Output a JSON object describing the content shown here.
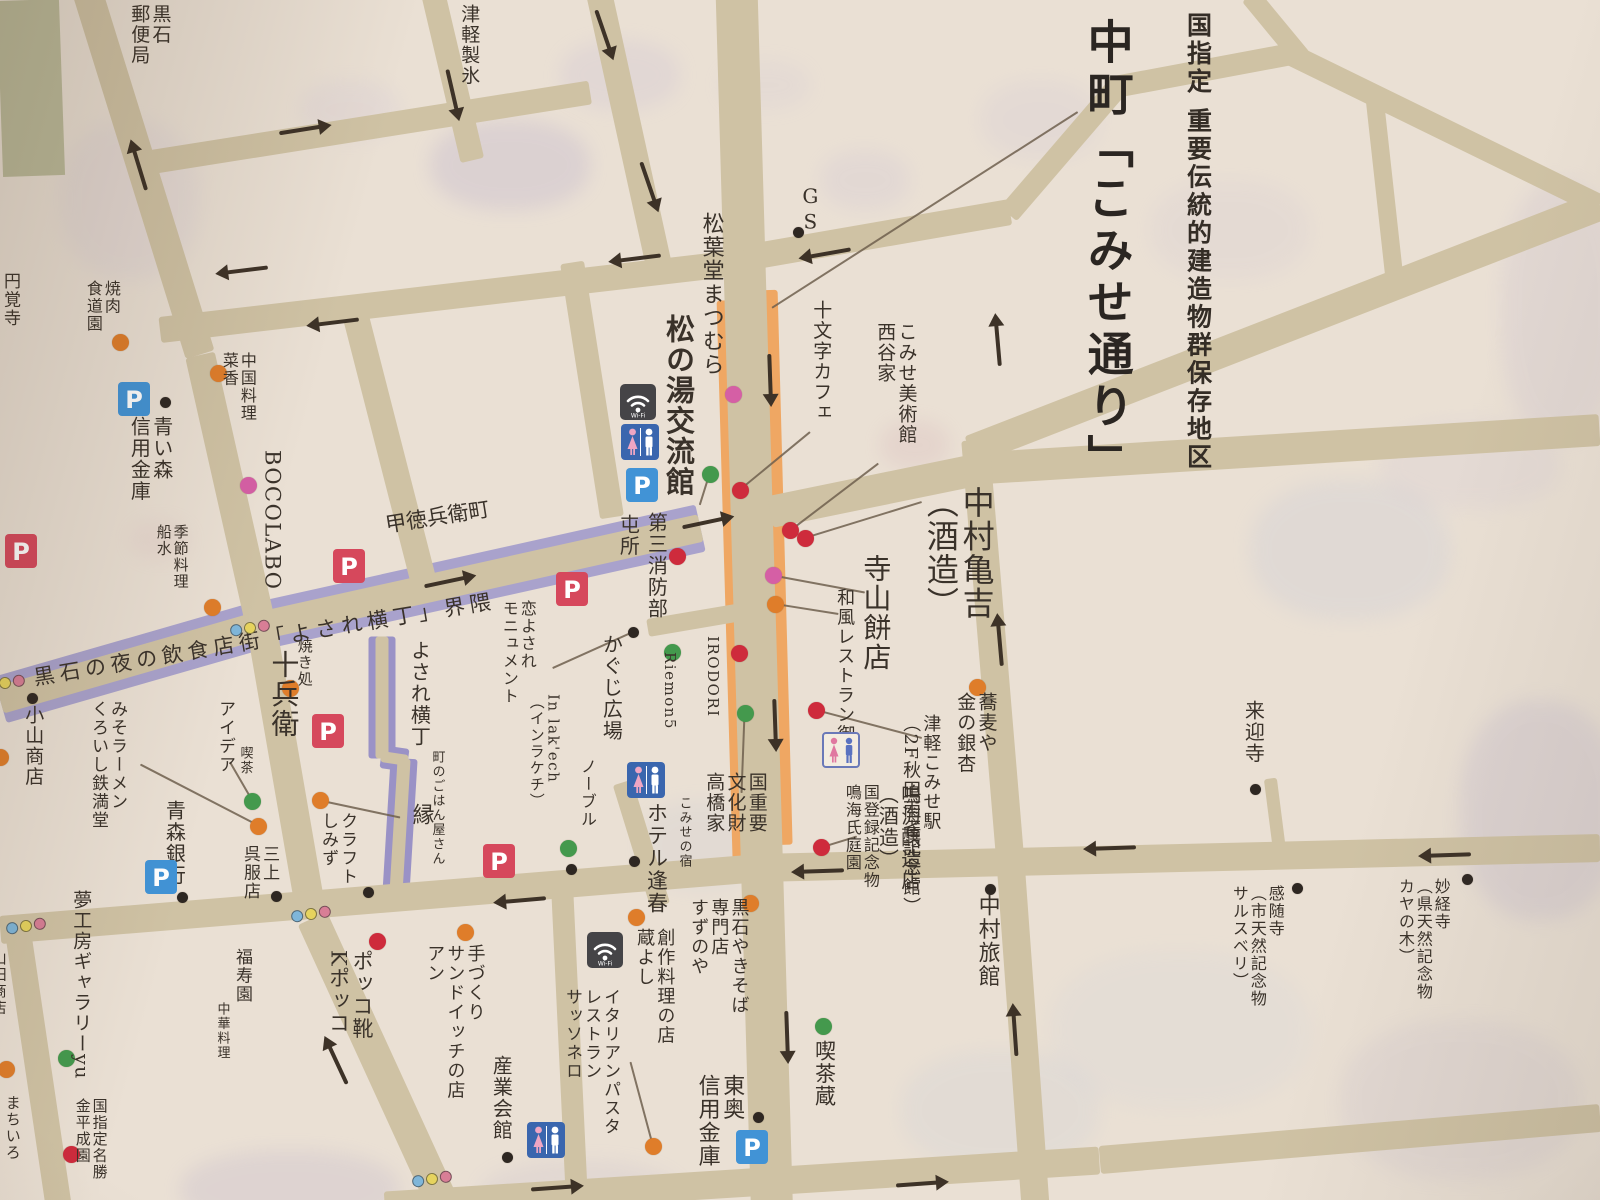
{
  "title": {
    "main": "中町「こみせ通り」",
    "sub": "国指定 重要伝統的建造物群保存地区"
  },
  "colors": {
    "paper": "#eae0d4",
    "road": "#cfc2a4",
    "purple": "#a9a2cc",
    "purple_lane": "#9a92c6",
    "arcade": "#efa763",
    "plaza": "#b7b795",
    "ink": "#3a322a",
    "arrow": "#3d3227",
    "leader_line": "#6e5f4e",
    "dot": {
      "o": "#df7d2a",
      "r": "#ce2b3c",
      "g": "#44994d",
      "p": "#d55fa5",
      "k": "#2e2722"
    },
    "traffic_light": [
      "#7fb6d9",
      "#e6d35e",
      "#d87e96"
    ],
    "parking_blue": "#4193d6",
    "parking_red": "#d6485c"
  },
  "plaza": {
    "x": 588,
    "y": 616,
    "w": 62,
    "h": 176
  },
  "roads": [
    [
      736,
      -20,
      772,
      1220,
      42
    ],
    [
      85,
      -15,
      200,
      355,
      30
    ],
    [
      200,
      355,
      263,
      635,
      30
    ],
    [
      263,
      635,
      312,
      918,
      30
    ],
    [
      312,
      918,
      448,
      1215,
      32
    ],
    [
      598,
      -10,
      660,
      272,
      26
    ],
    [
      572,
      262,
      612,
      517,
      24
    ],
    [
      130,
      165,
      590,
      92,
      24
    ],
    [
      432,
      -10,
      472,
      160,
      24
    ],
    [
      160,
      330,
      745,
      262,
      26
    ],
    [
      745,
      258,
      1010,
      212,
      26
    ],
    [
      1008,
      214,
      1118,
      86,
      22
    ],
    [
      1110,
      88,
      1292,
      54,
      22
    ],
    [
      970,
      450,
      1600,
      205,
      30
    ],
    [
      1287,
      52,
      1600,
      205,
      22
    ],
    [
      1250,
      -5,
      1302,
      58,
      20
    ],
    [
      1375,
      98,
      1397,
      298,
      18
    ],
    [
      0,
      700,
      250,
      628,
      28
    ],
    [
      250,
      628,
      700,
      528,
      28
    ],
    [
      770,
      512,
      985,
      468,
      32
    ],
    [
      985,
      468,
      1600,
      430,
      32
    ],
    [
      975,
      440,
      1010,
      860,
      28
    ],
    [
      1010,
      860,
      1035,
      1205,
      28
    ],
    [
      0,
      930,
      760,
      868,
      28
    ],
    [
      760,
      868,
      1600,
      848,
      28
    ],
    [
      385,
      1205,
      1100,
      1160,
      28
    ],
    [
      1100,
      1160,
      1600,
      1118,
      28
    ],
    [
      18,
      935,
      58,
      1205,
      26
    ],
    [
      352,
      300,
      427,
      593,
      26
    ],
    [
      648,
      628,
      742,
      612,
      18
    ],
    [
      622,
      782,
      660,
      905,
      20
    ],
    [
      382,
      636,
      382,
      758,
      13
    ],
    [
      381,
      756,
      408,
      760,
      11
    ],
    [
      404,
      758,
      396,
      890,
      13
    ],
    [
      1270,
      778,
      1280,
      856,
      13
    ],
    [
      562,
      888,
      577,
      1205,
      22
    ]
  ],
  "bands": {
    "purple": [
      [
        0,
        700,
        250,
        628,
        48
      ],
      [
        250,
        628,
        700,
        528,
        48
      ]
    ],
    "purple_lane": [
      [
        382,
        636,
        382,
        758,
        27
      ],
      [
        381,
        756,
        408,
        760,
        23
      ],
      [
        404,
        758,
        396,
        890,
        27
      ]
    ],
    "arcade": [
      [
        723,
        300,
        739,
        860,
        13
      ],
      [
        770,
        290,
        785,
        845,
        15
      ]
    ]
  },
  "labels": [
    {
      "n": "kuroishi-post-office",
      "t": "黒石\n郵便局",
      "x": 128,
      "y": 4,
      "s": 19,
      "v": 1
    },
    {
      "n": "tsugaru-seihyo",
      "t": "津軽製氷",
      "x": 458,
      "y": 4,
      "s": 19,
      "v": 1
    },
    {
      "n": "enkakuji-temple",
      "t": "円覚寺",
      "x": 0,
      "y": 272,
      "s": 17,
      "v": 1
    },
    {
      "n": "yakiniku-shokudoen",
      "t": "焼肉\n食道園",
      "x": 84,
      "y": 280,
      "s": 16,
      "v": 1
    },
    {
      "n": "aoimori-shinkin-bank",
      "t": "青い森\n信用金庫",
      "x": 128,
      "y": 416,
      "s": 20,
      "v": 1
    },
    {
      "n": "chinese-restaurant-saika",
      "t": "中国料理\n菜香",
      "x": 220,
      "y": 352,
      "s": 16,
      "v": 1
    },
    {
      "n": "bocolabo",
      "t": "BOCOLABO",
      "x": 260,
      "y": 450,
      "s": 21,
      "v": 1,
      "o": "s"
    },
    {
      "n": "kisetsu-ryori-funamizu",
      "t": "季節料理\n船水",
      "x": 155,
      "y": 524,
      "s": 15,
      "v": 1
    },
    {
      "n": "kotokubee-cho",
      "t": "甲徳兵衛町",
      "x": 385,
      "y": 506,
      "s": 21,
      "r": -9
    },
    {
      "n": "yosare-yokocho-street",
      "t": "黒石の夜の飲食店街「よされ横丁」界隈",
      "x": 30,
      "y": 620,
      "s": 21,
      "r": -9.5,
      "w": 570,
      "ls": 5
    },
    {
      "n": "tonsho",
      "t": "屯所",
      "x": 617,
      "y": 514,
      "s": 20,
      "v": 1
    },
    {
      "n": "daisan-shobobu",
      "t": "第三消防部",
      "x": 645,
      "y": 512,
      "s": 20,
      "v": 1
    },
    {
      "n": "matsubado-matsumura",
      "t": "松葉堂まつむら",
      "x": 698,
      "y": 212,
      "s": 22,
      "v": 1
    },
    {
      "n": "matsunoyu-koryukan",
      "t": "松の湯交流館",
      "x": 662,
      "y": 314,
      "s": 29,
      "v": 1,
      "b": 1
    },
    {
      "n": "gs-gas-station",
      "t": "GS",
      "x": 799,
      "y": 184,
      "s": 20,
      "v": 1,
      "o": "u"
    },
    {
      "n": "jumonji-cafe",
      "t": "十文字カフェ",
      "x": 810,
      "y": 300,
      "s": 19,
      "v": 1
    },
    {
      "n": "komise-museum-nishitaniya",
      "t": "こみせ美術館\n西谷家",
      "x": 874,
      "y": 322,
      "s": 19,
      "v": 1
    },
    {
      "n": "nakamura-kamekichi-brewery",
      "t": "中村亀吉\n（酒造）",
      "x": 922,
      "y": 486,
      "s": 32,
      "v": 1
    },
    {
      "n": "terayama-mochiten",
      "t": "寺山餅店",
      "x": 860,
      "y": 554,
      "s": 28,
      "v": 1
    },
    {
      "n": "wafu-restaurant-miyuki",
      "t": "和風レストラン御幸",
      "x": 834,
      "y": 588,
      "s": 18,
      "v": 1
    },
    {
      "n": "tsugaru-komise-station",
      "t": "津軽こみせ駅\n（2F秋田雨雀記念館）",
      "x": 900,
      "y": 714,
      "s": 18,
      "v": 1
    },
    {
      "n": "sobaya-kin-no-icho",
      "t": "蕎麦や\n金の銀杏",
      "x": 954,
      "y": 692,
      "s": 19,
      "v": 1
    },
    {
      "n": "narumi-garden",
      "t": "国登録記念物\n鳴海氏庭園",
      "x": 843,
      "y": 784,
      "s": 16,
      "v": 1
    },
    {
      "n": "narumi-jozoten-brewery",
      "t": "鳴海醸造店\n（酒造）",
      "x": 876,
      "y": 784,
      "s": 20,
      "v": 1
    },
    {
      "n": "nakamura-ryokan",
      "t": "中村旅館",
      "x": 974,
      "y": 894,
      "s": 22,
      "v": 1
    },
    {
      "n": "kissa-kura",
      "t": "喫茶蔵",
      "x": 812,
      "y": 1040,
      "s": 21,
      "v": 1
    },
    {
      "n": "toou-shinkin-bank",
      "t": "東奥\n信用金庫",
      "x": 694,
      "y": 1074,
      "s": 22,
      "v": 1
    },
    {
      "n": "kuroishi-yakisoba-suzunoya",
      "t": "黒石やきそば\n専門店\nすずのや",
      "x": 688,
      "y": 898,
      "s": 18,
      "v": 1
    },
    {
      "n": "kurayoshi",
      "t": "創作料理の店\n蔵よし",
      "x": 634,
      "y": 928,
      "s": 18,
      "v": 1
    },
    {
      "n": "sassonero",
      "t": "イタリアンパスタ\nレストラン\nサッソネロ",
      "x": 562,
      "y": 988,
      "s": 17,
      "v": 1
    },
    {
      "n": "komise-no-yado",
      "t": "こみせの宿",
      "x": 676,
      "y": 796,
      "s": 13,
      "v": 1
    },
    {
      "n": "hotel-hoshun",
      "t": "ホテル逢春",
      "x": 644,
      "y": 802,
      "s": 21,
      "v": 1
    },
    {
      "n": "noble",
      "t": "ノーブル",
      "x": 578,
      "y": 758,
      "s": 16,
      "v": 1
    },
    {
      "n": "in-lakech",
      "t": "In lak'ech\n（インラケチ）",
      "x": 528,
      "y": 694,
      "s": 15,
      "v": 1
    },
    {
      "n": "koiyosare-monument",
      "t": "恋よされ\nモニュメント",
      "x": 500,
      "y": 600,
      "s": 16,
      "v": 1
    },
    {
      "n": "kaguji-hiroba",
      "t": "かぐじ広場",
      "x": 600,
      "y": 634,
      "s": 20,
      "v": 1
    },
    {
      "n": "riemon5",
      "t": "Riemon5",
      "x": 661,
      "y": 652,
      "s": 15,
      "v": 1,
      "o": "s"
    },
    {
      "n": "irodori",
      "t": "IRODORI",
      "x": 704,
      "y": 636,
      "s": 15,
      "v": 1,
      "o": "s"
    },
    {
      "n": "takahashi-house",
      "t": "国重要\n文化財\n高橋家",
      "x": 703,
      "y": 772,
      "s": 19,
      "v": 1
    },
    {
      "n": "yosare-yokocho",
      "t": "よされ横丁",
      "x": 408,
      "y": 640,
      "s": 20,
      "v": 1
    },
    {
      "n": "yakidokoro",
      "t": "焼き処",
      "x": 296,
      "y": 638,
      "s": 15,
      "v": 1
    },
    {
      "n": "jube",
      "t": "十兵衛",
      "x": 268,
      "y": 650,
      "s": 28,
      "v": 1
    },
    {
      "n": "idea",
      "t": "アイデア",
      "x": 215,
      "y": 700,
      "s": 17,
      "v": 1
    },
    {
      "n": "kissa",
      "t": "喫茶",
      "x": 237,
      "y": 746,
      "s": 13,
      "v": 1
    },
    {
      "n": "aomori-bank",
      "t": "青森銀行",
      "x": 163,
      "y": 800,
      "s": 20,
      "v": 1
    },
    {
      "n": "mikami-gofukuten",
      "t": "三上\n呉服店",
      "x": 240,
      "y": 845,
      "s": 17,
      "v": 1
    },
    {
      "n": "craft-shimizu",
      "t": "クラフト\nしみず",
      "x": 318,
      "y": 812,
      "s": 17,
      "v": 1
    },
    {
      "n": "machi-no-gohanyasan",
      "t": "町のごはん屋さん",
      "x": 429,
      "y": 750,
      "s": 13,
      "v": 1
    },
    {
      "n": "en",
      "t": "縁",
      "x": 408,
      "y": 803,
      "s": 22,
      "v": 1
    },
    {
      "n": "miso-ramen-tetsumando",
      "t": "みそラーメン\nくろいし鉄満堂",
      "x": 88,
      "y": 700,
      "s": 17,
      "v": 1
    },
    {
      "n": "koyama-shoten",
      "t": "小山商店",
      "x": 22,
      "y": 705,
      "s": 19,
      "v": 1
    },
    {
      "n": "yumekobo-gallery-yu",
      "t": "夢工房ギャラリーyu",
      "x": 70,
      "y": 890,
      "s": 19,
      "v": 1
    },
    {
      "n": "kanehira-narien",
      "t": "国指定名勝\n金平成園",
      "x": 74,
      "y": 1098,
      "s": 15,
      "v": 1
    },
    {
      "n": "machiiro",
      "t": "まちいろ",
      "x": 4,
      "y": 1095,
      "s": 15,
      "v": 1
    },
    {
      "n": "yamada-shoten",
      "t": "山田商店",
      "x": -10,
      "y": 950,
      "s": 15,
      "v": 1
    },
    {
      "n": "fukujuen",
      "t": "福寿園",
      "x": 232,
      "y": 948,
      "s": 17,
      "v": 1
    },
    {
      "n": "chuka-ryori",
      "t": "中華料理",
      "x": 214,
      "y": 1002,
      "s": 13,
      "v": 1
    },
    {
      "n": "tezukuri-sandwich-an",
      "t": "手づくり\nサンドイッチの店\nアン",
      "x": 424,
      "y": 944,
      "s": 18,
      "v": 1
    },
    {
      "n": "pokko-shoes",
      "t": "ポッコ靴\nKポッコ",
      "x": 326,
      "y": 950,
      "s": 21,
      "v": 1
    },
    {
      "n": "sangyo-kaikan",
      "t": "産業会館",
      "x": 490,
      "y": 1055,
      "s": 20,
      "v": 1
    },
    {
      "n": "raigoji-temple",
      "t": "来迎寺",
      "x": 1242,
      "y": 700,
      "s": 20,
      "v": 1
    },
    {
      "n": "kanzuiji-temple",
      "t": "感随寺\n（市天然記念物\nサルスベリ）",
      "x": 1230,
      "y": 885,
      "s": 16,
      "v": 1
    },
    {
      "n": "myokyoji-temple",
      "t": "妙経寺\n（県天然記念物\nカヤの木）",
      "x": 1396,
      "y": 878,
      "s": 16,
      "v": 1
    }
  ],
  "dots": [
    [
      120,
      342,
      "o"
    ],
    [
      218,
      373,
      "o"
    ],
    [
      248,
      485,
      "p"
    ],
    [
      165,
      402,
      "k"
    ],
    [
      212,
      607,
      "o"
    ],
    [
      290,
      688,
      "o"
    ],
    [
      252,
      801,
      "g"
    ],
    [
      258,
      826,
      "o"
    ],
    [
      320,
      800,
      "o"
    ],
    [
      182,
      897,
      "k"
    ],
    [
      276,
      896,
      "k"
    ],
    [
      368,
      892,
      "k"
    ],
    [
      32,
      698,
      "k"
    ],
    [
      733,
      394,
      "p"
    ],
    [
      710,
      474,
      "g"
    ],
    [
      740,
      490,
      "r"
    ],
    [
      677,
      556,
      "r"
    ],
    [
      790,
      530,
      "r"
    ],
    [
      805,
      538,
      "r"
    ],
    [
      773,
      575,
      "p"
    ],
    [
      775,
      604,
      "o"
    ],
    [
      798,
      232,
      "k"
    ],
    [
      816,
      710,
      "r"
    ],
    [
      977,
      687,
      "o"
    ],
    [
      821,
      847,
      "r"
    ],
    [
      739,
      653,
      "r"
    ],
    [
      672,
      652,
      "g"
    ],
    [
      633,
      632,
      "k"
    ],
    [
      745,
      713,
      "g"
    ],
    [
      568,
      848,
      "g"
    ],
    [
      571,
      869,
      "k"
    ],
    [
      634,
      861,
      "k"
    ],
    [
      750,
      903,
      "o"
    ],
    [
      636,
      917,
      "o"
    ],
    [
      653,
      1146,
      "o"
    ],
    [
      758,
      1117,
      "k"
    ],
    [
      823,
      1026,
      "g"
    ],
    [
      990,
      889,
      "k"
    ],
    [
      507,
      1157,
      "k"
    ],
    [
      377,
      941,
      "r"
    ],
    [
      465,
      932,
      "o"
    ],
    [
      66,
      1058,
      "g"
    ],
    [
      71,
      1154,
      "r"
    ],
    [
      6,
      1069,
      "o"
    ],
    [
      1255,
      789,
      "k"
    ],
    [
      1297,
      888,
      "k"
    ],
    [
      1467,
      879,
      "k"
    ],
    [
      0,
      757,
      "o"
    ]
  ],
  "leader_lines": [
    [
      1078,
      112,
      772,
      308
    ],
    [
      810,
      432,
      742,
      488
    ],
    [
      700,
      505,
      710,
      473
    ],
    [
      922,
      502,
      805,
      538
    ],
    [
      878,
      463,
      790,
      530
    ],
    [
      865,
      592,
      773,
      575
    ],
    [
      838,
      614,
      775,
      604
    ],
    [
      922,
      738,
      816,
      710
    ],
    [
      857,
      836,
      821,
      847
    ],
    [
      633,
      632,
      553,
      668
    ],
    [
      745,
      713,
      742,
      793
    ],
    [
      140,
      764,
      258,
      825
    ],
    [
      320,
      800,
      400,
      817
    ],
    [
      630,
      1062,
      652,
      1144
    ],
    [
      230,
      762,
      252,
      800
    ]
  ],
  "arrows": [
    [
      140,
      170,
      -107
    ],
    [
      300,
      130,
      -9
    ],
    [
      452,
      90,
      77
    ],
    [
      603,
      30,
      71
    ],
    [
      648,
      182,
      71
    ],
    [
      247,
      270,
      173
    ],
    [
      338,
      322,
      173
    ],
    [
      640,
      258,
      173
    ],
    [
      830,
      253,
      170
    ],
    [
      445,
      582,
      -12
    ],
    [
      703,
      523,
      -12
    ],
    [
      770,
      375,
      88
    ],
    [
      775,
      720,
      88
    ],
    [
      787,
      1032,
      88
    ],
    [
      998,
      345,
      -95
    ],
    [
      1000,
      645,
      -95
    ],
    [
      1015,
      1035,
      -94
    ],
    [
      525,
      900,
      175
    ],
    [
      823,
      871,
      178
    ],
    [
      1115,
      848,
      178
    ],
    [
      1450,
      855,
      178
    ],
    [
      552,
      1188,
      -4
    ],
    [
      917,
      1184,
      -4
    ],
    [
      338,
      1065,
      -115
    ]
  ],
  "icons": [
    [
      "wifi",
      620,
      384
    ],
    [
      "wifi",
      587,
      932
    ],
    [
      "wc",
      621,
      424
    ],
    [
      "wc",
      627,
      762
    ],
    [
      "wc",
      527,
      1122
    ],
    [
      "wc2",
      822,
      732
    ],
    [
      "pb",
      118,
      382
    ],
    [
      "pb",
      626,
      468
    ],
    [
      "pb",
      145,
      860
    ],
    [
      "pb",
      736,
      1130
    ],
    [
      "pr",
      333,
      549
    ],
    [
      "pr",
      556,
      572
    ],
    [
      "pr",
      312,
      714
    ],
    [
      "pr",
      483,
      844
    ],
    [
      "pr",
      5,
      534
    ],
    [
      "tl",
      247,
      627
    ],
    [
      "tl",
      308,
      913
    ],
    [
      "tl",
      429,
      1178
    ],
    [
      "tl",
      23,
      925
    ],
    [
      "tl",
      2,
      682
    ]
  ]
}
